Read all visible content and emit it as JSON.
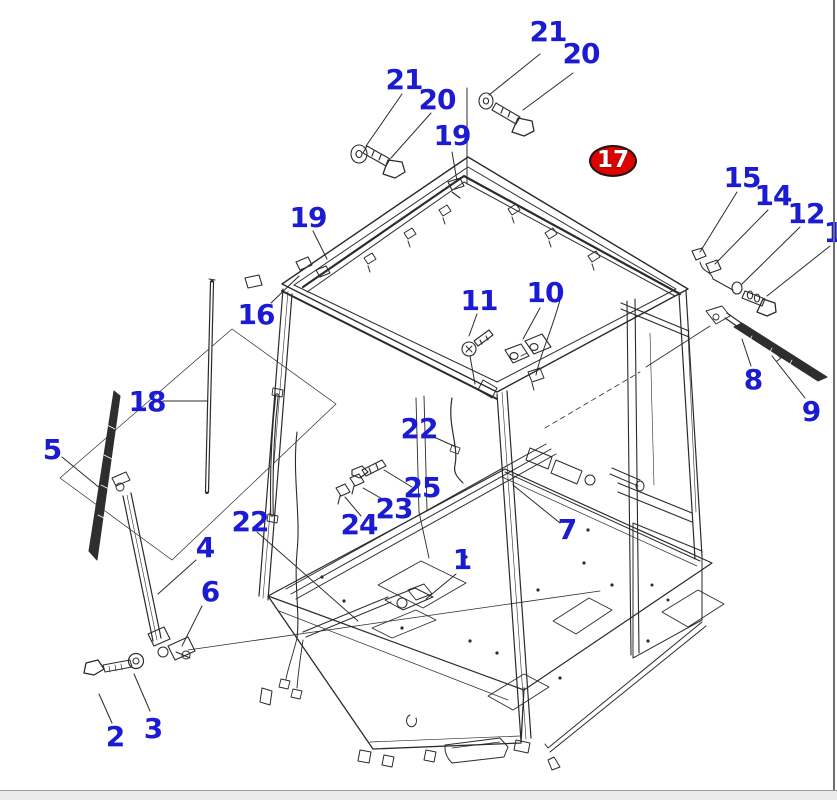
{
  "window": {
    "background_color": "#ffffff",
    "right_border_color": "#6d6d6d",
    "footer_strip_color": "#ebebeb"
  },
  "diagram": {
    "description": "Isometric exploded parts diagram of an operator cab assembly with wiper, bolts, clips and harness callouts",
    "line_color": "#2b2b2b",
    "label_color": "#1b1bd2",
    "highlight_fill": "#dd0303",
    "highlight_text_color": "#ffffff",
    "callouts": [
      {
        "text": "21",
        "x": 548,
        "y": 32,
        "highlighted": false
      },
      {
        "text": "20",
        "x": 581,
        "y": 54,
        "highlighted": false
      },
      {
        "text": "21",
        "x": 404,
        "y": 80,
        "highlighted": false
      },
      {
        "text": "20",
        "x": 437,
        "y": 100,
        "highlighted": false
      },
      {
        "text": "19",
        "x": 452,
        "y": 136,
        "highlighted": false
      },
      {
        "text": "17",
        "x": 613,
        "y": 161,
        "highlighted": true
      },
      {
        "text": "15",
        "x": 742,
        "y": 178,
        "highlighted": false
      },
      {
        "text": "14",
        "x": 773,
        "y": 196,
        "highlighted": false
      },
      {
        "text": "12",
        "x": 806,
        "y": 214,
        "highlighted": false
      },
      {
        "text": "1",
        "x": 833,
        "y": 233,
        "highlighted": false
      },
      {
        "text": "19",
        "x": 308,
        "y": 218,
        "highlighted": false
      },
      {
        "text": "11",
        "x": 479,
        "y": 301,
        "highlighted": false
      },
      {
        "text": "10",
        "x": 545,
        "y": 293,
        "highlighted": false
      },
      {
        "text": "16",
        "x": 256,
        "y": 315,
        "highlighted": false
      },
      {
        "text": "18",
        "x": 147,
        "y": 402,
        "highlighted": false
      },
      {
        "text": "5",
        "x": 52,
        "y": 450,
        "highlighted": false
      },
      {
        "text": "8",
        "x": 753,
        "y": 380,
        "highlighted": false
      },
      {
        "text": "9",
        "x": 811,
        "y": 412,
        "highlighted": false
      },
      {
        "text": "22",
        "x": 419,
        "y": 429,
        "highlighted": false
      },
      {
        "text": "25",
        "x": 422,
        "y": 488,
        "highlighted": false
      },
      {
        "text": "23",
        "x": 394,
        "y": 509,
        "highlighted": false
      },
      {
        "text": "24",
        "x": 359,
        "y": 525,
        "highlighted": false
      },
      {
        "text": "22",
        "x": 250,
        "y": 522,
        "highlighted": false
      },
      {
        "text": "4",
        "x": 205,
        "y": 548,
        "highlighted": false
      },
      {
        "text": "1",
        "x": 462,
        "y": 560,
        "highlighted": false
      },
      {
        "text": "7",
        "x": 567,
        "y": 530,
        "highlighted": false
      },
      {
        "text": "6",
        "x": 210,
        "y": 592,
        "highlighted": false
      },
      {
        "text": "2",
        "x": 115,
        "y": 737,
        "highlighted": false
      },
      {
        "text": "3",
        "x": 153,
        "y": 729,
        "highlighted": false
      }
    ]
  }
}
